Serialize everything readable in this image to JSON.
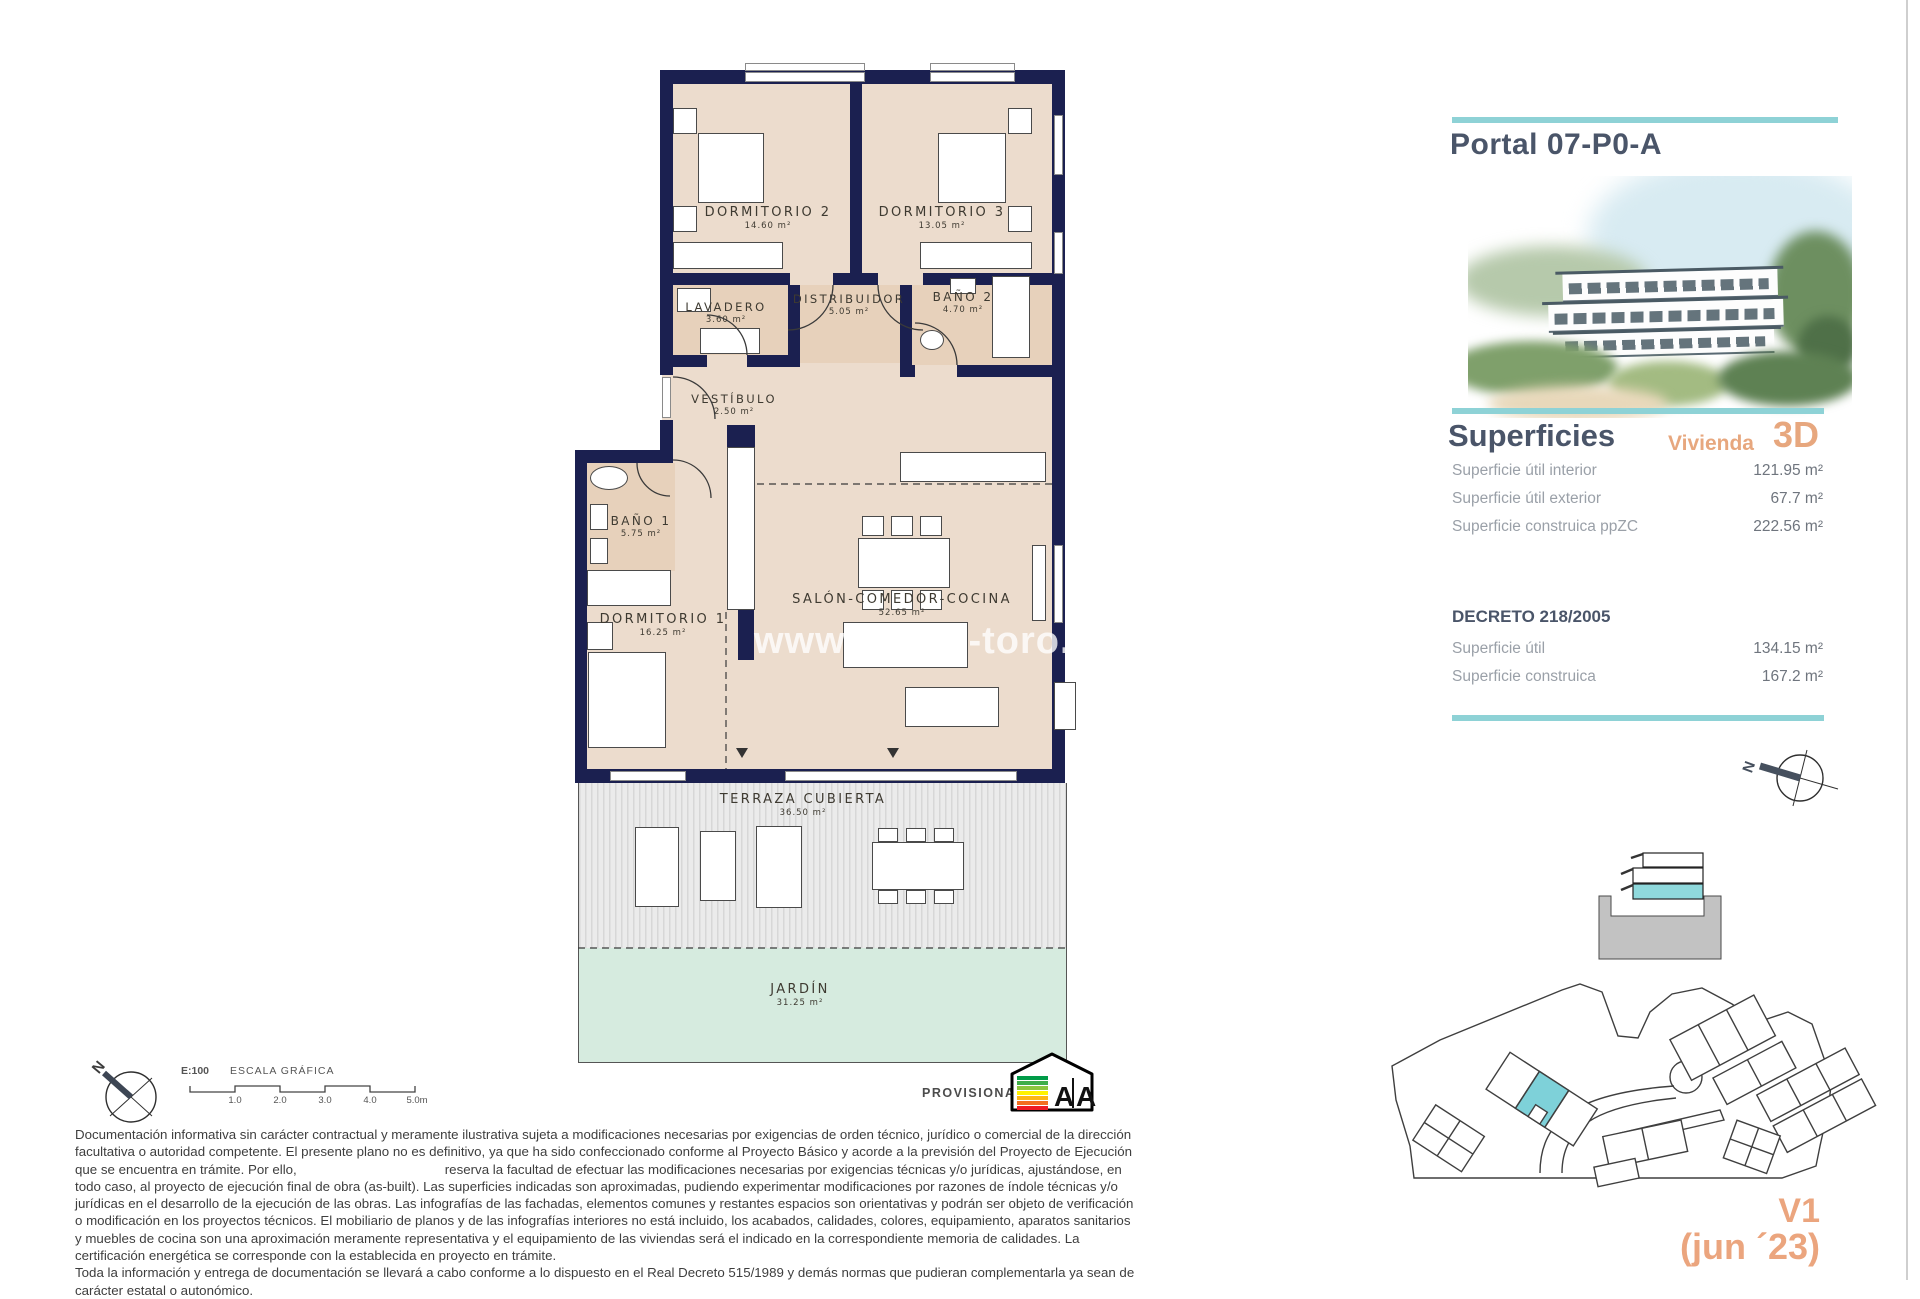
{
  "plan": {
    "watermark": "www.grupo-toro.com",
    "rooms": [
      {
        "name": "DORMITORIO 2",
        "area": "14.60 m²"
      },
      {
        "name": "DORMITORIO 3",
        "area": "13.05 m²"
      },
      {
        "name": "LAVADERO",
        "area": "3.60 m²"
      },
      {
        "name": "DISTRIBUIDOR",
        "area": "5.05 m²"
      },
      {
        "name": "BAÑO 2",
        "area": "4.70 m²"
      },
      {
        "name": "VESTÍBULO",
        "area": "2.50 m²"
      },
      {
        "name": "BAÑO 1",
        "area": "5.75 m²"
      },
      {
        "name": "DORMITORIO 1",
        "area": "16.25 m²"
      },
      {
        "name": "SALÓN-COMEDOR-COCINA",
        "area": "52.65 m²"
      },
      {
        "name": "TERRAZA CUBIERTA",
        "area": "36.50 m²"
      },
      {
        "name": "JARDÍN",
        "area": "31.25 m²"
      }
    ]
  },
  "scalebar": {
    "ratio": "E:100",
    "title": "ESCALA GRÁFICA",
    "ticks": [
      "1.0",
      "2.0",
      "3.0",
      "4.0",
      "5.0m"
    ]
  },
  "compass": {
    "letter": "N"
  },
  "stamp": {
    "label": "PROVISIONAL",
    "energy_letters": [
      "A",
      "A"
    ]
  },
  "panel": {
    "title": "Portal 07-P0-A",
    "superficies_title": "Superficies",
    "vivienda_label": "Vivienda",
    "vivienda_code": "3D",
    "superficies_rows": [
      {
        "label": "Superficie útil interior",
        "value": "121.95 m²"
      },
      {
        "label": "Superficie útil exterior",
        "value": "67.7 m²"
      },
      {
        "label": "Superficie construica ppZC",
        "value": "222.56 m²"
      }
    ],
    "decreto_title": "DECRETO 218/2005",
    "decreto_rows": [
      {
        "label": "Superficie útil",
        "value": "134.15 m²"
      },
      {
        "label": "Superficie construica",
        "value": "167.2 m²"
      }
    ],
    "version": "V1",
    "version_date": "(jun ´23)"
  },
  "legal": {
    "p1_before": "Documentación informativa sin carácter contractual y meramente ilustrativa sujeta a modificaciones necesarias por exigencias de orden técnico, jurídico o comercial de la dirección facultativa o autoridad competente. El presente plano no es definitivo, ya que ha sido  confeccionado conforme al Proyecto Básico y acorde a la previsión del Proyecto de Ejecución que se encuentra en trámite. Por ello,",
    "p1_after": "reserva la facultad de efectuar las modificaciones necesarias por exigencias técnicas y/o jurídicas, ajustándose, en todo caso, al proyecto de ejecución final de obra (as-built). Las superficies indicadas son aproximadas, pudiendo experimentar modificaciones por razones de índole técnicas y/o jurídicas en el desarrollo de la ejecución de las obras. Las infografías de las fachadas, elementos comunes y restantes espacios son orientativas y podrán ser objeto de verificación o modificación en los proyectos técnicos. El mobiliario de planos y de las infografías interiores no está incluido, los acabados, calidades, colores, equipamiento, aparatos sanitarios y muebles de cocina son una aproximación meramente representativa y el equipamiento de las viviendas será el indicado en la correspondiente memoria de calidades. La certificación energética se corresponde con la establecida en proyecto en trámite.",
    "p2": "Toda la información y entrega de documentación se llevará a cabo conforme a lo dispuesto en el Real Decreto 515/1989 y demás normas que pudieran complementarla ya sean de carácter estatal o autonómico."
  },
  "colors": {
    "wall": "#1b2050",
    "floor": "#ecdccd",
    "wet_floor": "#e7d1bb",
    "terrace": "#e6e6e6",
    "garden": "#d6ebdf",
    "teal": "#8ed2d6",
    "accent_orange": "#e7a77e",
    "heading": "#4a5569",
    "unit_highlight": "#7ed1d9"
  }
}
